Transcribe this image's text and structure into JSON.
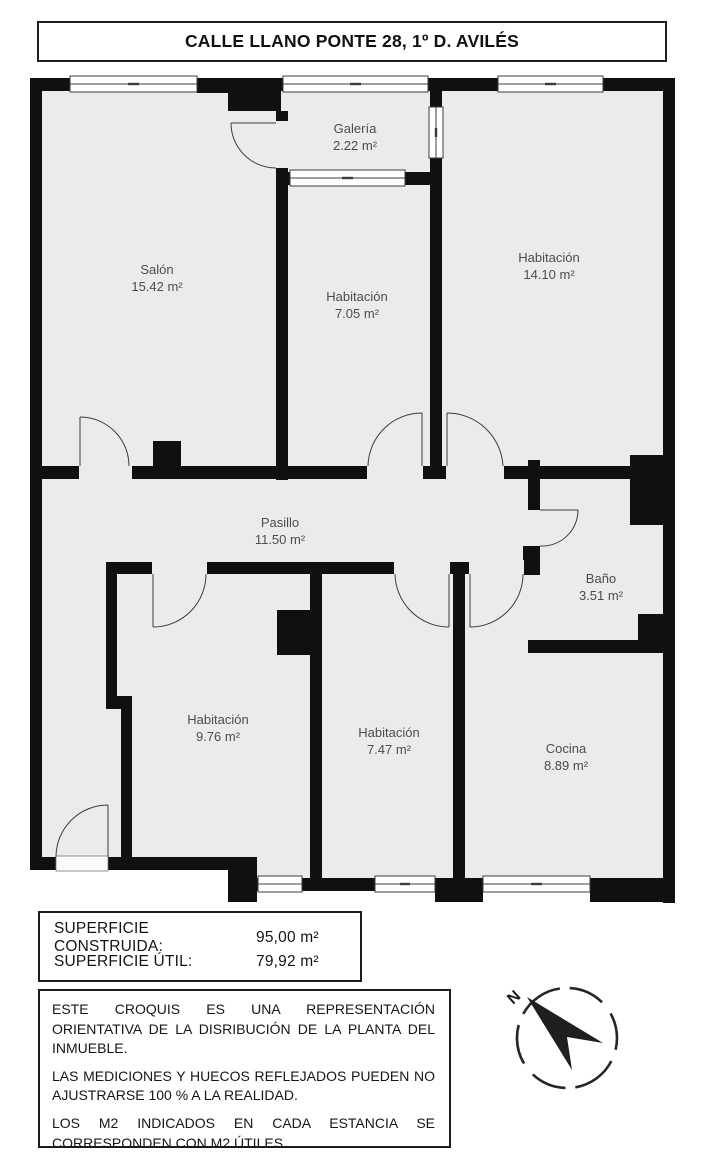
{
  "title": "CALLE LLANO PONTE 28, 1º D. AVILÉS",
  "floorplan": {
    "rooms": [
      {
        "name": "Salón",
        "area": "15.42 m²"
      },
      {
        "name": "Galería",
        "area": "2.22 m²"
      },
      {
        "name": "Habitación",
        "area": "7.05 m²"
      },
      {
        "name": "Habitación",
        "area": "14.10 m²"
      },
      {
        "name": "Pasillo",
        "area": "11.50 m²"
      },
      {
        "name": "Baño",
        "area": "3.51 m²"
      },
      {
        "name": "Habitación",
        "area": "9.76 m²"
      },
      {
        "name": "Habitación",
        "area": "7.47 m²"
      },
      {
        "name": "Cocina",
        "area": "8.89 m²"
      }
    ],
    "colors": {
      "wall": "#101010",
      "room_fill": "#ebebeb",
      "label_text": "#4d4d4d"
    }
  },
  "surface_box": {
    "rows": [
      {
        "label": "SUPERFICIE CONSTRUIDA:",
        "value": "95,00 m²"
      },
      {
        "label": "SUPERFICIE ÚTIL:",
        "value": "79,92 m²"
      }
    ]
  },
  "disclaimer": {
    "paragraphs": [
      "ESTE CROQUIS ES UNA REPRESENTACIÓN ORIENTATIVA DE LA DISRIBUCIÓN DE LA PLANTA DEL INMUEBLE.",
      "LAS MEDICIONES Y HUECOS REFLEJADOS PUEDEN NO AJUSTRARSE 100 % A LA REALIDAD.",
      "LOS M2 INDICADOS EN CADA ESTANCIA SE CORRESPONDEN CON M2 ÚTILES."
    ]
  },
  "compass": {
    "north_label": "N"
  }
}
